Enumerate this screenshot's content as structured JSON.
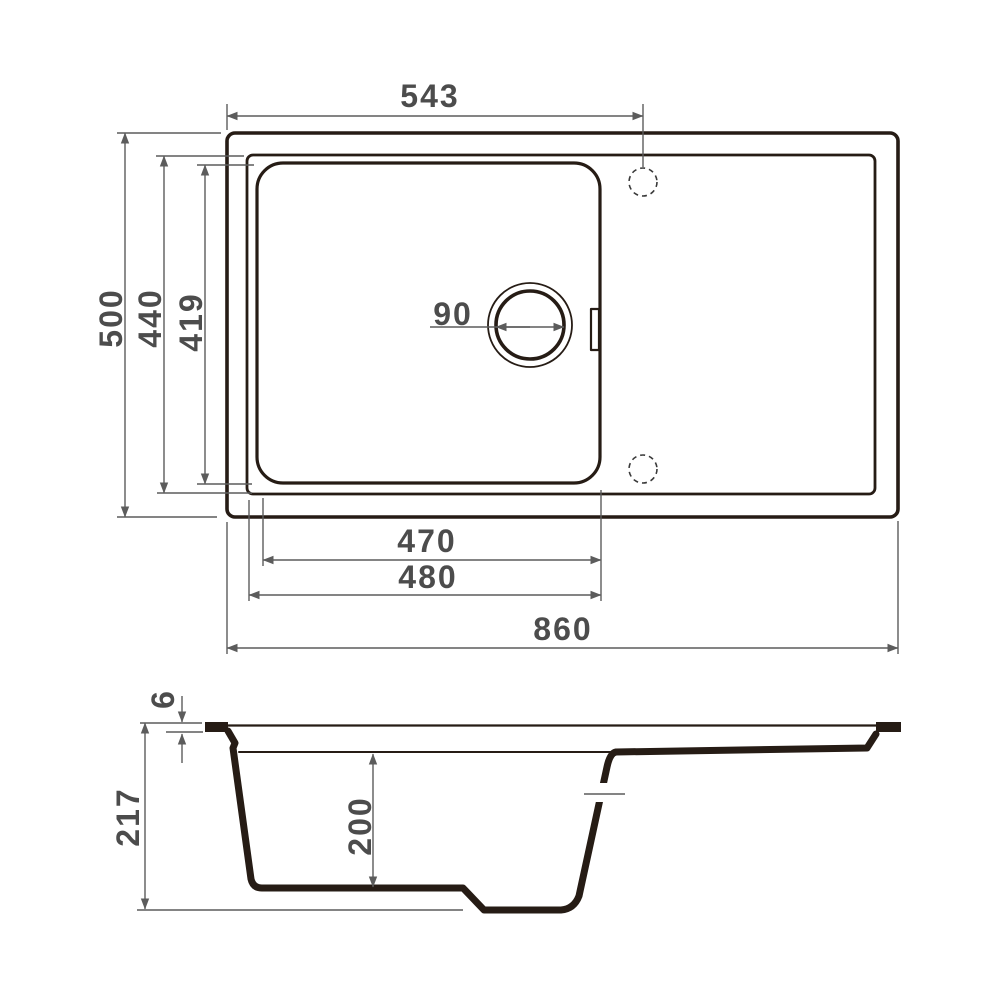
{
  "colors": {
    "ink": "#261c15",
    "dimension_lines": "#5c5c5c",
    "labels": "#4c4c4c",
    "background": "#ffffff"
  },
  "top_view": {
    "dims": {
      "tap_center_from_left": "543",
      "overall_depth": "500",
      "rim_inner_depth": "440",
      "bowl_inner_depth": "419",
      "drain_diameter": "90",
      "bowl_width": "470",
      "bowl_outer_width": "480",
      "overall_width": "860"
    }
  },
  "side_view": {
    "dims": {
      "rim_thickness": "6",
      "overall_height": "217",
      "bowl_depth": "200"
    }
  }
}
